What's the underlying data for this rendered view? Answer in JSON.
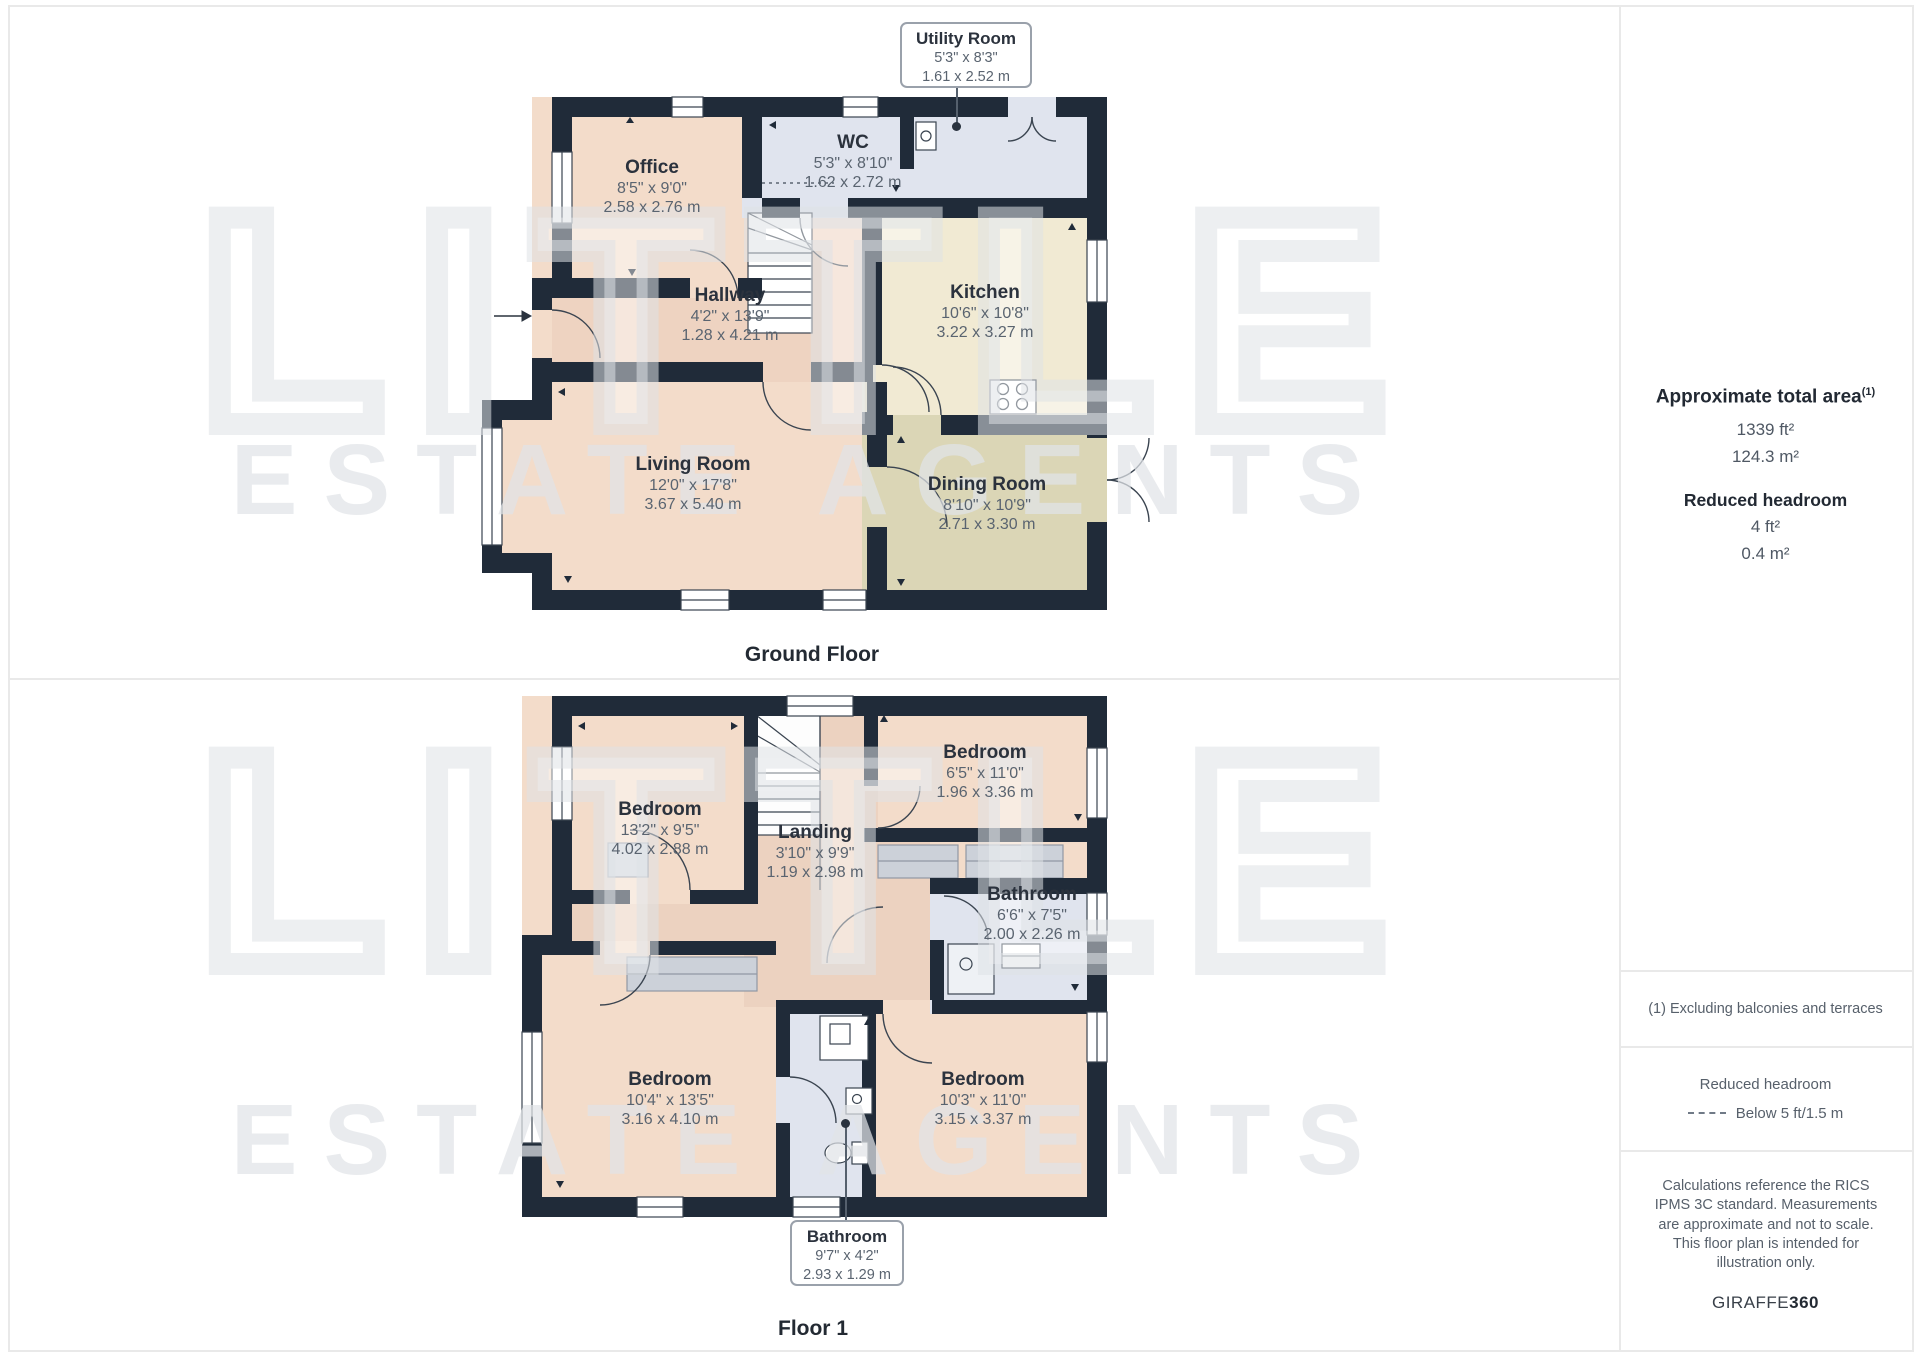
{
  "floors": [
    {
      "label": "Ground Floor",
      "rooms": {
        "office": {
          "name": "Office",
          "imperial": "8'5\" x 9'0\"",
          "metric": "2.58 x 2.76 m"
        },
        "wc": {
          "name": "WC",
          "imperial": "5'3\" x 8'10\"",
          "metric": "1.62 x 2.72 m"
        },
        "hallway": {
          "name": "Hallway",
          "imperial": "4'2\" x 13'9\"",
          "metric": "1.28 x 4.21 m"
        },
        "kitchen": {
          "name": "Kitchen",
          "imperial": "10'6\" x 10'8\"",
          "metric": "3.22 x 3.27 m"
        },
        "living": {
          "name": "Living Room",
          "imperial": "12'0\" x 17'8\"",
          "metric": "3.67 x 5.40 m"
        },
        "dining": {
          "name": "Dining Room",
          "imperial": "8'10\" x 10'9\"",
          "metric": "2.71 x 3.30 m"
        }
      },
      "callout": {
        "name": "Utility Room",
        "imperial": "5'3\" x 8'3\"",
        "metric": "1.61 x 2.52 m"
      }
    },
    {
      "label": "Floor 1",
      "rooms": {
        "bedroom_tl": {
          "name": "Bedroom",
          "imperial": "13'2\" x 9'5\"",
          "metric": "4.02 x 2.88 m"
        },
        "landing": {
          "name": "Landing",
          "imperial": "3'10\" x 9'9\"",
          "metric": "1.19 x 2.98 m"
        },
        "bedroom_tr": {
          "name": "Bedroom",
          "imperial": "6'5\" x 11'0\"",
          "metric": "1.96 x 3.36 m"
        },
        "bathroom": {
          "name": "Bathroom",
          "imperial": "6'6\" x 7'5\"",
          "metric": "2.00 x 2.26 m"
        },
        "bedroom_bl": {
          "name": "Bedroom",
          "imperial": "10'4\" x 13'5\"",
          "metric": "3.16 x 4.10 m"
        },
        "bedroom_br": {
          "name": "Bedroom",
          "imperial": "10'3\" x 11'0\"",
          "metric": "3.15 x 3.37 m"
        }
      },
      "callout": {
        "name": "Bathroom",
        "imperial": "9'7\" x 4'2\"",
        "metric": "2.93 x 1.29 m"
      }
    }
  ],
  "sidebar": {
    "total_area_heading": "Approximate total area",
    "total_area_footnote_marker": "(1)",
    "total_area_ft": "1339 ft²",
    "total_area_m": "124.3 m²",
    "reduced_headroom_heading": "Reduced headroom",
    "reduced_headroom_ft": "4 ft²",
    "reduced_headroom_m": "0.4 m²",
    "footnote": "(1) Excluding balconies and terraces",
    "legend_heading": "Reduced headroom",
    "legend_label": "Below 5 ft/1.5 m",
    "disclaimer": "Calculations reference the RICS IPMS 3C standard. Measurements are approximate and not to scale. This floor plan is intended for illustration only.",
    "brand_name": "GIRAFFE",
    "brand_suffix": "360"
  },
  "watermark": {
    "line1": "LITTLE",
    "line2": "ESTATE AGENTS"
  },
  "colors": {
    "wall": "#202b39",
    "room_peach": "#f3dcca",
    "hall_peach": "#eed3c1",
    "kitchen_beige": "#f1ead3",
    "dining_olive": "#dbd6b6",
    "bath_blue": "#e0e4ee",
    "wardrobe_gray": "#ccd1d9",
    "label_dark": "#2b323d",
    "label_gray": "#5a6470",
    "divider_gray": "#e9e9e9",
    "watermark_gray": "#ececec"
  }
}
